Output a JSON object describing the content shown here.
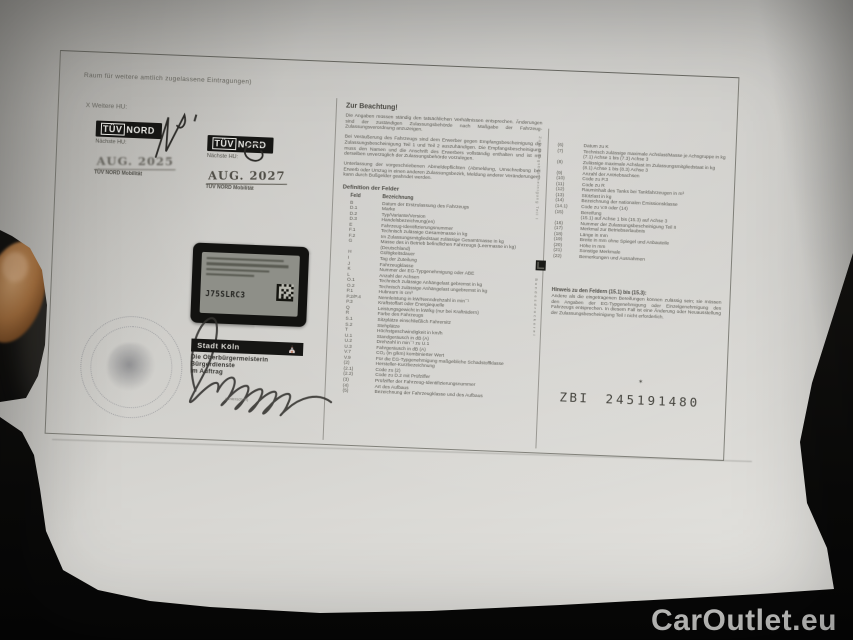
{
  "colors": {
    "background": "#12110f",
    "paper": "#cfcecb",
    "sticker_black": "#121210",
    "stamp_ink": "#504e47",
    "watermark_text": "#d6d6d4"
  },
  "watermark": {
    "text": "CarOutlet.eu"
  },
  "paper_doc": {
    "entries_area": {
      "note": "Raum für weitere amtlich zugelassene Eintragungen)",
      "next_hu_label": "X Weitere HU:",
      "stickers": [
        {
          "brand_tuv": "TÜV",
          "brand_nord": "NORD",
          "label": "Nächste HU:",
          "date": "AUG. 2025",
          "footer": "TÜV NORD Mobilität"
        },
        {
          "brand_tuv": "TÜV",
          "brand_nord": "NORD",
          "label": "Nächste HU:",
          "date": "AUG. 2027",
          "footer": "TÜV NORD Mobilität"
        }
      ],
      "registration_sticker": {
        "code": "J75SLRC3"
      },
      "city_stamp": {
        "city": "Stadt Köln",
        "line1": "Die Oberbürgermeisterin",
        "line2": "Bürgerdienste",
        "line3": "im Auftrag",
        "caption": "(Unterschrift)"
      }
    },
    "notice": {
      "title": "Zur Beachtung!",
      "paragraphs": [
        "Die Angaben müssen ständig den tatsächlichen Verhältnissen entsprechen. Änderungen sind der zuständigen Zulassungsbehörde nach Maßgabe der Fahrzeug-Zulassungsverordnung anzuzeigen.",
        "Bei Veräußerung des Fahrzeugs sind dem Erwerber gegen Empfangsbescheinigung die Zulassungsbescheinigung Teil 1 und Teil 2 auszuhändigen. Die Empfangsbescheinigung muss den Namen und die Anschrift des Erwerbers vollständig enthalten und ist mit derselben unverzüglich der Zulassungsbehörde vorzulegen.",
        "Unterlassung der vorgeschriebenen Abmeldepflichten (Abmeldung, Umschreibung bei Erwerb oder Umzug in einen anderen Zulassungsbezirk, Meldung anderer Veränderungen) kann durch Bußgelder geahndet werden."
      ]
    },
    "field_definitions": {
      "title": "Definition der Felder",
      "col_code": "Feld",
      "col_desc": "Bezeichnung",
      "left_rows": [
        {
          "c": "B",
          "d": "Datum der Erstzulassung des Fahrzeugs"
        },
        {
          "c": "D.1",
          "d": "Marke"
        },
        {
          "c": "D.2",
          "d": "Typ/Variante/Version"
        },
        {
          "c": "D.3",
          "d": "Handelsbezeichnung(en)"
        },
        {
          "c": "E",
          "d": "Fahrzeug-Identifizierungsnummer"
        },
        {
          "c": "F.1",
          "d": "Technisch zulässige Gesamtmasse in kg"
        },
        {
          "c": "F.2",
          "d": "Im Zulassungsmitgliedstaat zulässige Gesamtmasse in kg"
        },
        {
          "c": "G",
          "d": "Masse des in Betrieb befindlichen Fahrzeugs (Leermasse in kg) (Deutschland)"
        },
        {
          "c": "H",
          "d": "Gültigkeitsdauer"
        },
        {
          "c": "I",
          "d": "Tag der Zuteilung"
        },
        {
          "c": "J",
          "d": "Fahrzeugklasse"
        },
        {
          "c": "K",
          "d": "Nummer der EG-Typgenehmigung oder ABE"
        },
        {
          "c": "L",
          "d": "Anzahl der Achsen"
        },
        {
          "c": "O.1",
          "d": "Technisch zulässige Anhängelast gebremst in kg"
        },
        {
          "c": "O.2",
          "d": "Technisch zulässige Anhängelast ungebremst in kg"
        },
        {
          "c": "P.1",
          "d": "Hubraum in cm³"
        },
        {
          "c": "P.2/P.4",
          "d": "Nennleistung in kW/Nenndrehzahl in min¯¹"
        },
        {
          "c": "P.3",
          "d": "Kraftstoffart oder Energiequelle"
        },
        {
          "c": "Q",
          "d": "Leistungsgewicht in kW/kg (nur bei Krafträdern)"
        },
        {
          "c": "R",
          "d": "Farbe des Fahrzeugs"
        },
        {
          "c": "S.1",
          "d": "Sitzplätze einschließlich Fahrersitz"
        },
        {
          "c": "S.2",
          "d": "Stehplätze"
        },
        {
          "c": "T",
          "d": "Höchstgeschwindigkeit in km/h"
        },
        {
          "c": "U.1",
          "d": "Standgeräusch in dB (A)"
        },
        {
          "c": "U.2",
          "d": "Drehzahl in min¯¹ zu U.1"
        },
        {
          "c": "U.3",
          "d": "Fahrgeräusch in dB (A)"
        },
        {
          "c": "V.7",
          "d": "CO₂ (in g/km) kombinierter Wert"
        },
        {
          "c": "V.9",
          "d": "Für die EG-Typgenehmigung maßgebliche Schadstoffklasse"
        },
        {
          "c": "(2)",
          "d": "Hersteller-Kurzbezeichnung"
        },
        {
          "c": "(2.1)",
          "d": "Code zu (2)"
        },
        {
          "c": "(2.2)",
          "d": "Code zu D.2 mit Prüfziffer"
        },
        {
          "c": "(3)",
          "d": "Prüfziffer der Fahrzeug-Identifizierungsnummer"
        },
        {
          "c": "(4)",
          "d": "Art des Aufbaus"
        },
        {
          "c": "(5)",
          "d": "Bezeichnung der Fahrzeugklasse und des Aufbaus"
        }
      ],
      "right_rows": [
        {
          "c": "(6)",
          "d": "Datum zu K"
        },
        {
          "c": "(7)",
          "d": "Technisch zulässige maximale Achslast/Masse je Achsgruppe in kg"
        },
        {
          "c": "",
          "d": "(7.1) Achse 1 bis (7.3) Achse 3"
        },
        {
          "c": "(8)",
          "d": "Zulässige maximale Achslast im Zulassungsmitgliedstaat in kg"
        },
        {
          "c": "",
          "d": "(8.1) Achse 1 bis (8.3) Achse 3"
        },
        {
          "c": "(9)",
          "d": "Anzahl der Antriebsachsen"
        },
        {
          "c": "(10)",
          "d": "Code zu P.3"
        },
        {
          "c": "(11)",
          "d": "Code zu R"
        },
        {
          "c": "(12)",
          "d": "Rauminhalt des Tanks bei Tankfahrzeugen in m³"
        },
        {
          "c": "(13)",
          "d": "Stützlast in kg"
        },
        {
          "c": "(14)",
          "d": "Bezeichnung der nationalen Emissionsklasse"
        },
        {
          "c": "(14.1)",
          "d": "Code zu V.9 oder (14)"
        },
        {
          "c": "(15)",
          "d": "Bereifung"
        },
        {
          "c": "",
          "d": "(15.1) auf Achse 1 bis (15.3) auf Achse 3"
        },
        {
          "c": "(16)",
          "d": "Nummer der Zulassungsbescheinigung Teil II"
        },
        {
          "c": "(17)",
          "d": "Merkmal zur Betriebserlaubnis"
        },
        {
          "c": "(18)",
          "d": "Länge in mm"
        },
        {
          "c": "(19)",
          "d": "Breite in mm ohne Spiegel und Anbauteile"
        },
        {
          "c": "(20)",
          "d": "Höhe in mm"
        },
        {
          "c": "(21)",
          "d": "Sonstige Merkmale"
        },
        {
          "c": "(22)",
          "d": "Bemerkungen und Ausnahmen"
        }
      ]
    },
    "tyre_note": {
      "title": "Hinweis zu den Feldern (15.1) bis (15.3):",
      "text": "Andere als die eingetragenen Bereifungen können zulässig sein; sie müssen den Angaben der EG-Typgenehmigung oder Einzelgenehmigung des Fahrzeugs entsprechen. In diesem Fall ist eine Änderung oder Neuausstellung der Zulassungsbescheinigung Teil I nicht erforderlich."
    },
    "serial": {
      "prefix": "ZBI",
      "number": "245191480",
      "star": "✶"
    },
    "vertical_label": "Zulassungsbescheinigung Teil I",
    "vertical_label2": "Bundesdruckerei"
  }
}
